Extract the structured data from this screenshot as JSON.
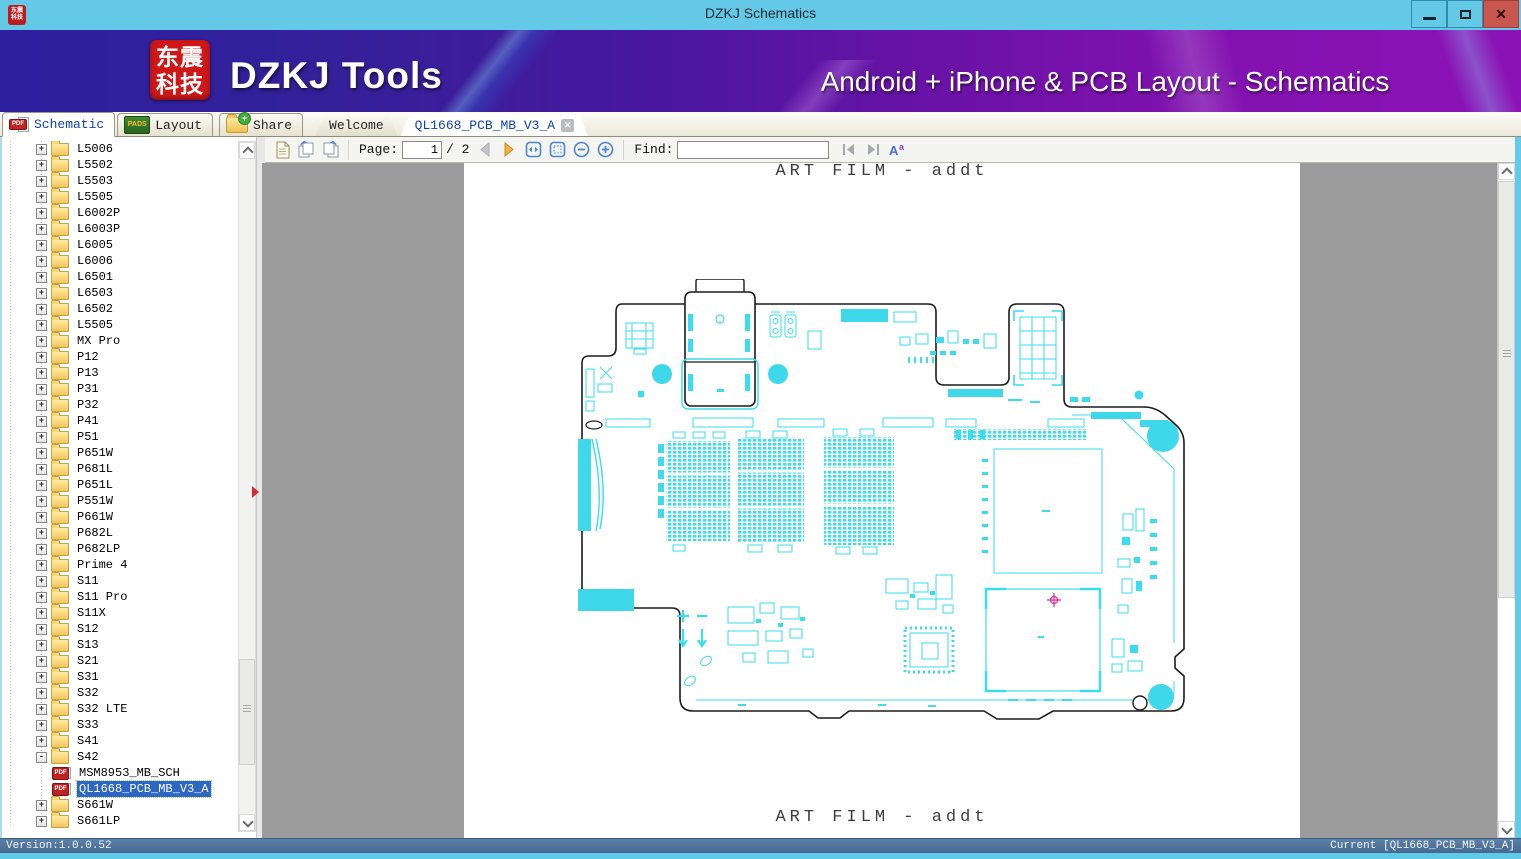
{
  "window": {
    "title": "DZKJ Schematics"
  },
  "banner": {
    "logo_line1": "东震",
    "logo_line2": "科技",
    "brand": "DZKJ Tools",
    "tagline": "Android + iPhone & PCB Layout - Schematics"
  },
  "icons": {
    "close": "✕",
    "doc_tab_close": "✕",
    "pdf_badge": "PDF",
    "pads_badge": "PADS",
    "minimize": "bar-shape",
    "maximize": "square-outline",
    "tree_collapse_marker": "right-red-triangle"
  },
  "mode_tabs": [
    {
      "label": "Schematic",
      "badge": "PDF",
      "active": true
    },
    {
      "label": "Layout",
      "badge": "PADS",
      "active": false
    },
    {
      "label": "Share",
      "active": false
    }
  ],
  "doc_tabs": [
    {
      "label": "Welcome",
      "active": false
    },
    {
      "label": "QL1668_PCB_MB_V3_A",
      "active": true
    }
  ],
  "toolbar": {
    "page_label": "Page:",
    "page_value": "1",
    "page_total": "/ 2",
    "find_label": "Find:",
    "find_value": ""
  },
  "sidebar": {
    "items": [
      {
        "label": "L5006",
        "twisty": "+",
        "icon": "folder",
        "state": "d1"
      },
      {
        "label": "L5502",
        "twisty": "+",
        "icon": "folder",
        "state": "d1"
      },
      {
        "label": "L5503",
        "twisty": "+",
        "icon": "folder",
        "state": "d1"
      },
      {
        "label": "L5505",
        "twisty": "+",
        "icon": "folder",
        "state": "d1"
      },
      {
        "label": "L6002P",
        "twisty": "+",
        "icon": "folder",
        "state": "d1"
      },
      {
        "label": "L6003P",
        "twisty": "+",
        "icon": "folder",
        "state": "d1"
      },
      {
        "label": "L6005",
        "twisty": "+",
        "icon": "folder",
        "state": "d1"
      },
      {
        "label": "L6006",
        "twisty": "+",
        "icon": "folder",
        "state": "d1"
      },
      {
        "label": "L6501",
        "twisty": "+",
        "icon": "folder",
        "state": "d1"
      },
      {
        "label": "L6503",
        "twisty": "+",
        "icon": "folder",
        "state": "d1"
      },
      {
        "label": "L6502",
        "twisty": "+",
        "icon": "folder",
        "state": "d1"
      },
      {
        "label": "L5505",
        "twisty": "+",
        "icon": "folder",
        "state": "d1"
      },
      {
        "label": "MX Pro",
        "twisty": "+",
        "icon": "folder",
        "state": "d1"
      },
      {
        "label": "P12",
        "twisty": "+",
        "icon": "folder",
        "state": "d1"
      },
      {
        "label": "P13",
        "twisty": "+",
        "icon": "folder",
        "state": "d1"
      },
      {
        "label": "P31",
        "twisty": "+",
        "icon": "folder",
        "state": "d1"
      },
      {
        "label": "P32",
        "twisty": "+",
        "icon": "folder",
        "state": "d1"
      },
      {
        "label": "P41",
        "twisty": "+",
        "icon": "folder",
        "state": "d1"
      },
      {
        "label": "P51",
        "twisty": "+",
        "icon": "folder",
        "state": "d1"
      },
      {
        "label": "P651W",
        "twisty": "+",
        "icon": "folder",
        "state": "d1"
      },
      {
        "label": "P681L",
        "twisty": "+",
        "icon": "folder",
        "state": "d1"
      },
      {
        "label": "P651L",
        "twisty": "+",
        "icon": "folder",
        "state": "d1"
      },
      {
        "label": "P551W",
        "twisty": "+",
        "icon": "folder",
        "state": "d1"
      },
      {
        "label": "P661W",
        "twisty": "+",
        "icon": "folder",
        "state": "d1"
      },
      {
        "label": "P682L",
        "twisty": "+",
        "icon": "folder",
        "state": "d1"
      },
      {
        "label": "P682LP",
        "twisty": "+",
        "icon": "folder",
        "state": "d1"
      },
      {
        "label": "Prime 4",
        "twisty": "+",
        "icon": "folder",
        "state": "d1"
      },
      {
        "label": "S11",
        "twisty": "+",
        "icon": "folder",
        "state": "d1"
      },
      {
        "label": "S11 Pro",
        "twisty": "+",
        "icon": "folder",
        "state": "d1"
      },
      {
        "label": "S11X",
        "twisty": "+",
        "icon": "folder",
        "state": "d1"
      },
      {
        "label": "S12",
        "twisty": "+",
        "icon": "folder",
        "state": "d1"
      },
      {
        "label": "S13",
        "twisty": "+",
        "icon": "folder",
        "state": "d1"
      },
      {
        "label": "S21",
        "twisty": "+",
        "icon": "folder",
        "state": "d1"
      },
      {
        "label": "S31",
        "twisty": "+",
        "icon": "folder",
        "state": "d1"
      },
      {
        "label": "S32",
        "twisty": "+",
        "icon": "folder",
        "state": "d1"
      },
      {
        "label": "S32 LTE",
        "twisty": "+",
        "icon": "folder",
        "state": "d1"
      },
      {
        "label": "S33",
        "twisty": "+",
        "icon": "folder",
        "state": "d1"
      },
      {
        "label": "S41",
        "twisty": "+",
        "icon": "folder",
        "state": "d1"
      },
      {
        "label": "S42",
        "twisty": "-",
        "icon": "folder",
        "state": "d1"
      },
      {
        "label": "MSM8953_MB_SCH",
        "twisty": "",
        "icon": "pdf",
        "badge": "PDF",
        "state": "d2"
      },
      {
        "label": "QL1668_PCB_MB_V3_A",
        "twisty": "",
        "icon": "pdf",
        "badge": "PDF",
        "state": "d2 sel"
      },
      {
        "label": "S661W",
        "twisty": "+",
        "icon": "folder",
        "state": "d1"
      },
      {
        "label": "S661LP",
        "twisty": "+",
        "icon": "folder",
        "state": "d1"
      }
    ]
  },
  "document": {
    "header": "ART FILM - addt",
    "footer": "ART FILM - addt"
  },
  "statusbar": {
    "version": "Version:1.0.0.52",
    "current": "Current [QL1668_PCB_MB_V3_A]"
  },
  "colors": {
    "titlebar": "#63c9e6",
    "close_button": "#c9564f",
    "banner_blue": "#2c209e",
    "banner_purple": "#8c12b5",
    "selection_blue": "#2e66c4",
    "pcb_cyan": "#3adcee",
    "pcb_marker_magenta": "#e8259a",
    "statusbar_blue": "#4a6d94"
  }
}
